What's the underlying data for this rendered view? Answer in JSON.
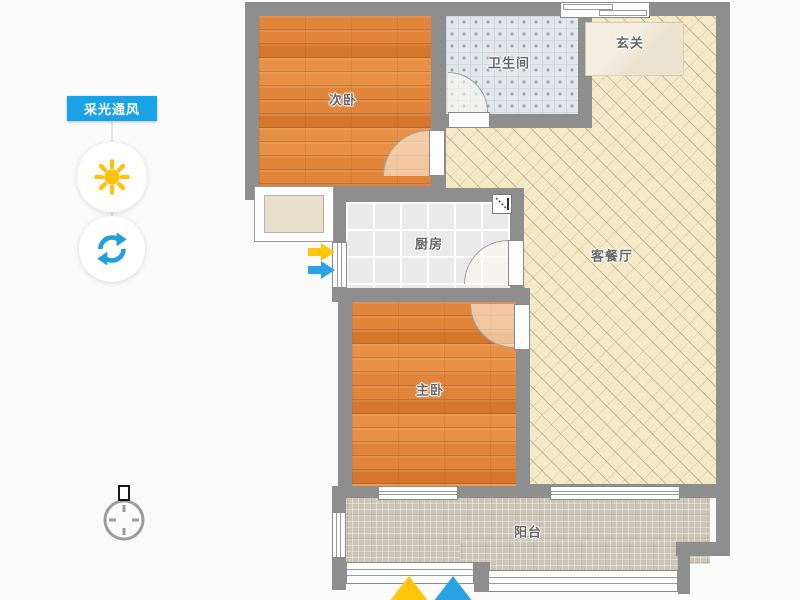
{
  "panel": {
    "label": "采光通风",
    "accent_color": "#19A3E6"
  },
  "icons": {
    "sun_color": "#FFC10E",
    "refresh_color": "#1E9FE0",
    "arrow_yellow": "#FFC60B",
    "arrow_blue": "#29A3E3"
  },
  "floorplan": {
    "rooms": {
      "secondary_bedroom": "次卧",
      "bathroom": "卫生间",
      "entry": "玄关",
      "living_dining": "客餐厅",
      "kitchen": "厨房",
      "master_bedroom": "主卧",
      "balcony": "阳台"
    },
    "colors": {
      "wall": "#8E8E8E",
      "wood_floor": "#DF8236",
      "living_tile": "#F5EAC8",
      "bath_tile": "#E3E9EB",
      "kitchen_tile": "#EBEBEB",
      "balcony_tile": "#CBC5B8"
    }
  }
}
